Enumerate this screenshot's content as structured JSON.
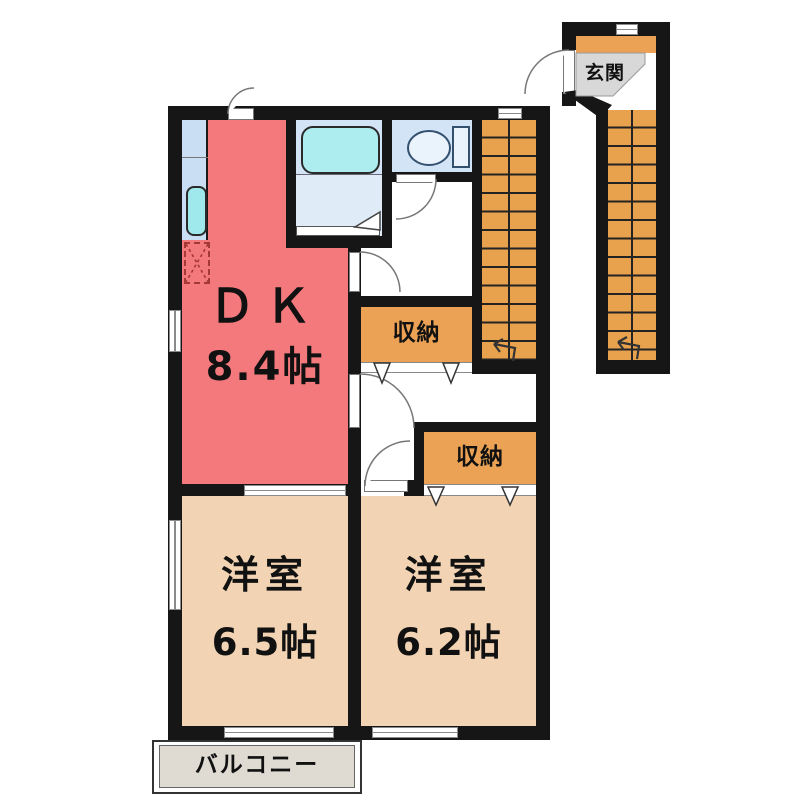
{
  "plan": {
    "rooms": {
      "dk": {
        "name": "ＤＫ",
        "size": "8.4帖"
      },
      "western1": {
        "name": "洋室",
        "size": "6.5帖"
      },
      "western2": {
        "name": "洋室",
        "size": "6.2帖"
      }
    },
    "labels": {
      "closet1": "収納",
      "closet2": "収納",
      "entrance": "玄関",
      "balcony": "バルコニー"
    },
    "colors": {
      "wall": "#161616",
      "dk_fill": "#F4797C",
      "western_room_fill": "#F2D4B4",
      "closet_fill": "#EBA254",
      "stairs_fill": "#E8A24E",
      "balcony_fill": "#DFDAD2",
      "entrance_floor_fill": "#D8D8D8",
      "water_area_fill": "#D3E4F6",
      "bathtub_fill": "#ADEDF0",
      "kitchen_counter_fill": "#C9DEF2"
    }
  }
}
